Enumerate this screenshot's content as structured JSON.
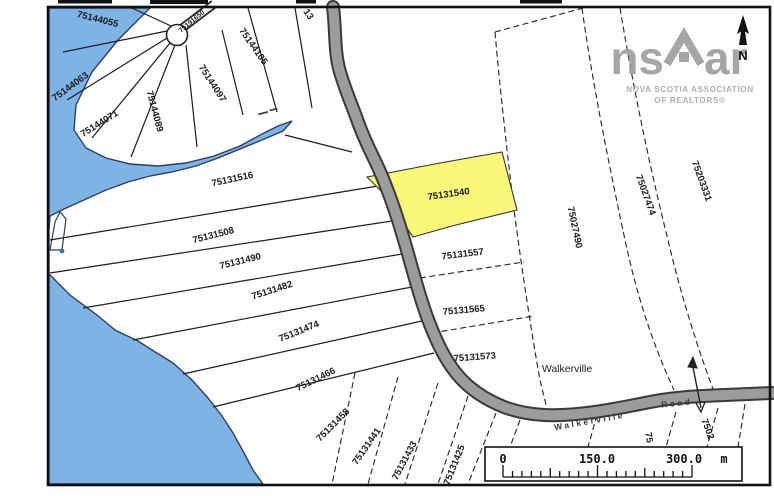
{
  "map": {
    "region_label": "Walkerville",
    "road_label": {
      "part1": "Walkerville",
      "part2": "Road"
    },
    "highlighted_pid": "75131540",
    "subdivision_parcels": [
      "75144055",
      "75144063",
      "75144071",
      "75144089",
      "75144097",
      "75144105"
    ],
    "culdesac_road_pid": "75191650",
    "shore_parcels": [
      "75131516",
      "75131508",
      "75131490",
      "75131482",
      "75131474",
      "75131466",
      "75131458",
      "75131441",
      "75131433",
      "75131425"
    ],
    "road_parcels": [
      "75131540",
      "75131557",
      "75131565",
      "75131573"
    ],
    "east_parcels": [
      "75027490",
      "75027474",
      "75203331"
    ],
    "partial_labels": {
      "top": "13",
      "bottom_left": "75",
      "bottom_right": "7502"
    },
    "colors": {
      "water": "#7db4e5",
      "water_edge": "#2b3f66",
      "road": "#9c9c9c",
      "road_edge": "#3a3a3a",
      "highlight": "#f8f778",
      "parcel_line": "#1c1c1c",
      "logo_gray": "#9b9b9b"
    }
  },
  "branding": {
    "logo_left": "ns",
    "logo_right": "ar",
    "assoc_line1": "NOVA SCOTIA ASSOCIATION",
    "assoc_line2": "OF REALTORS®"
  },
  "compass": {
    "north": "N"
  },
  "scale_bar": {
    "t0": "0",
    "t1": "150.0",
    "t2": "300.0",
    "unit": "m"
  }
}
